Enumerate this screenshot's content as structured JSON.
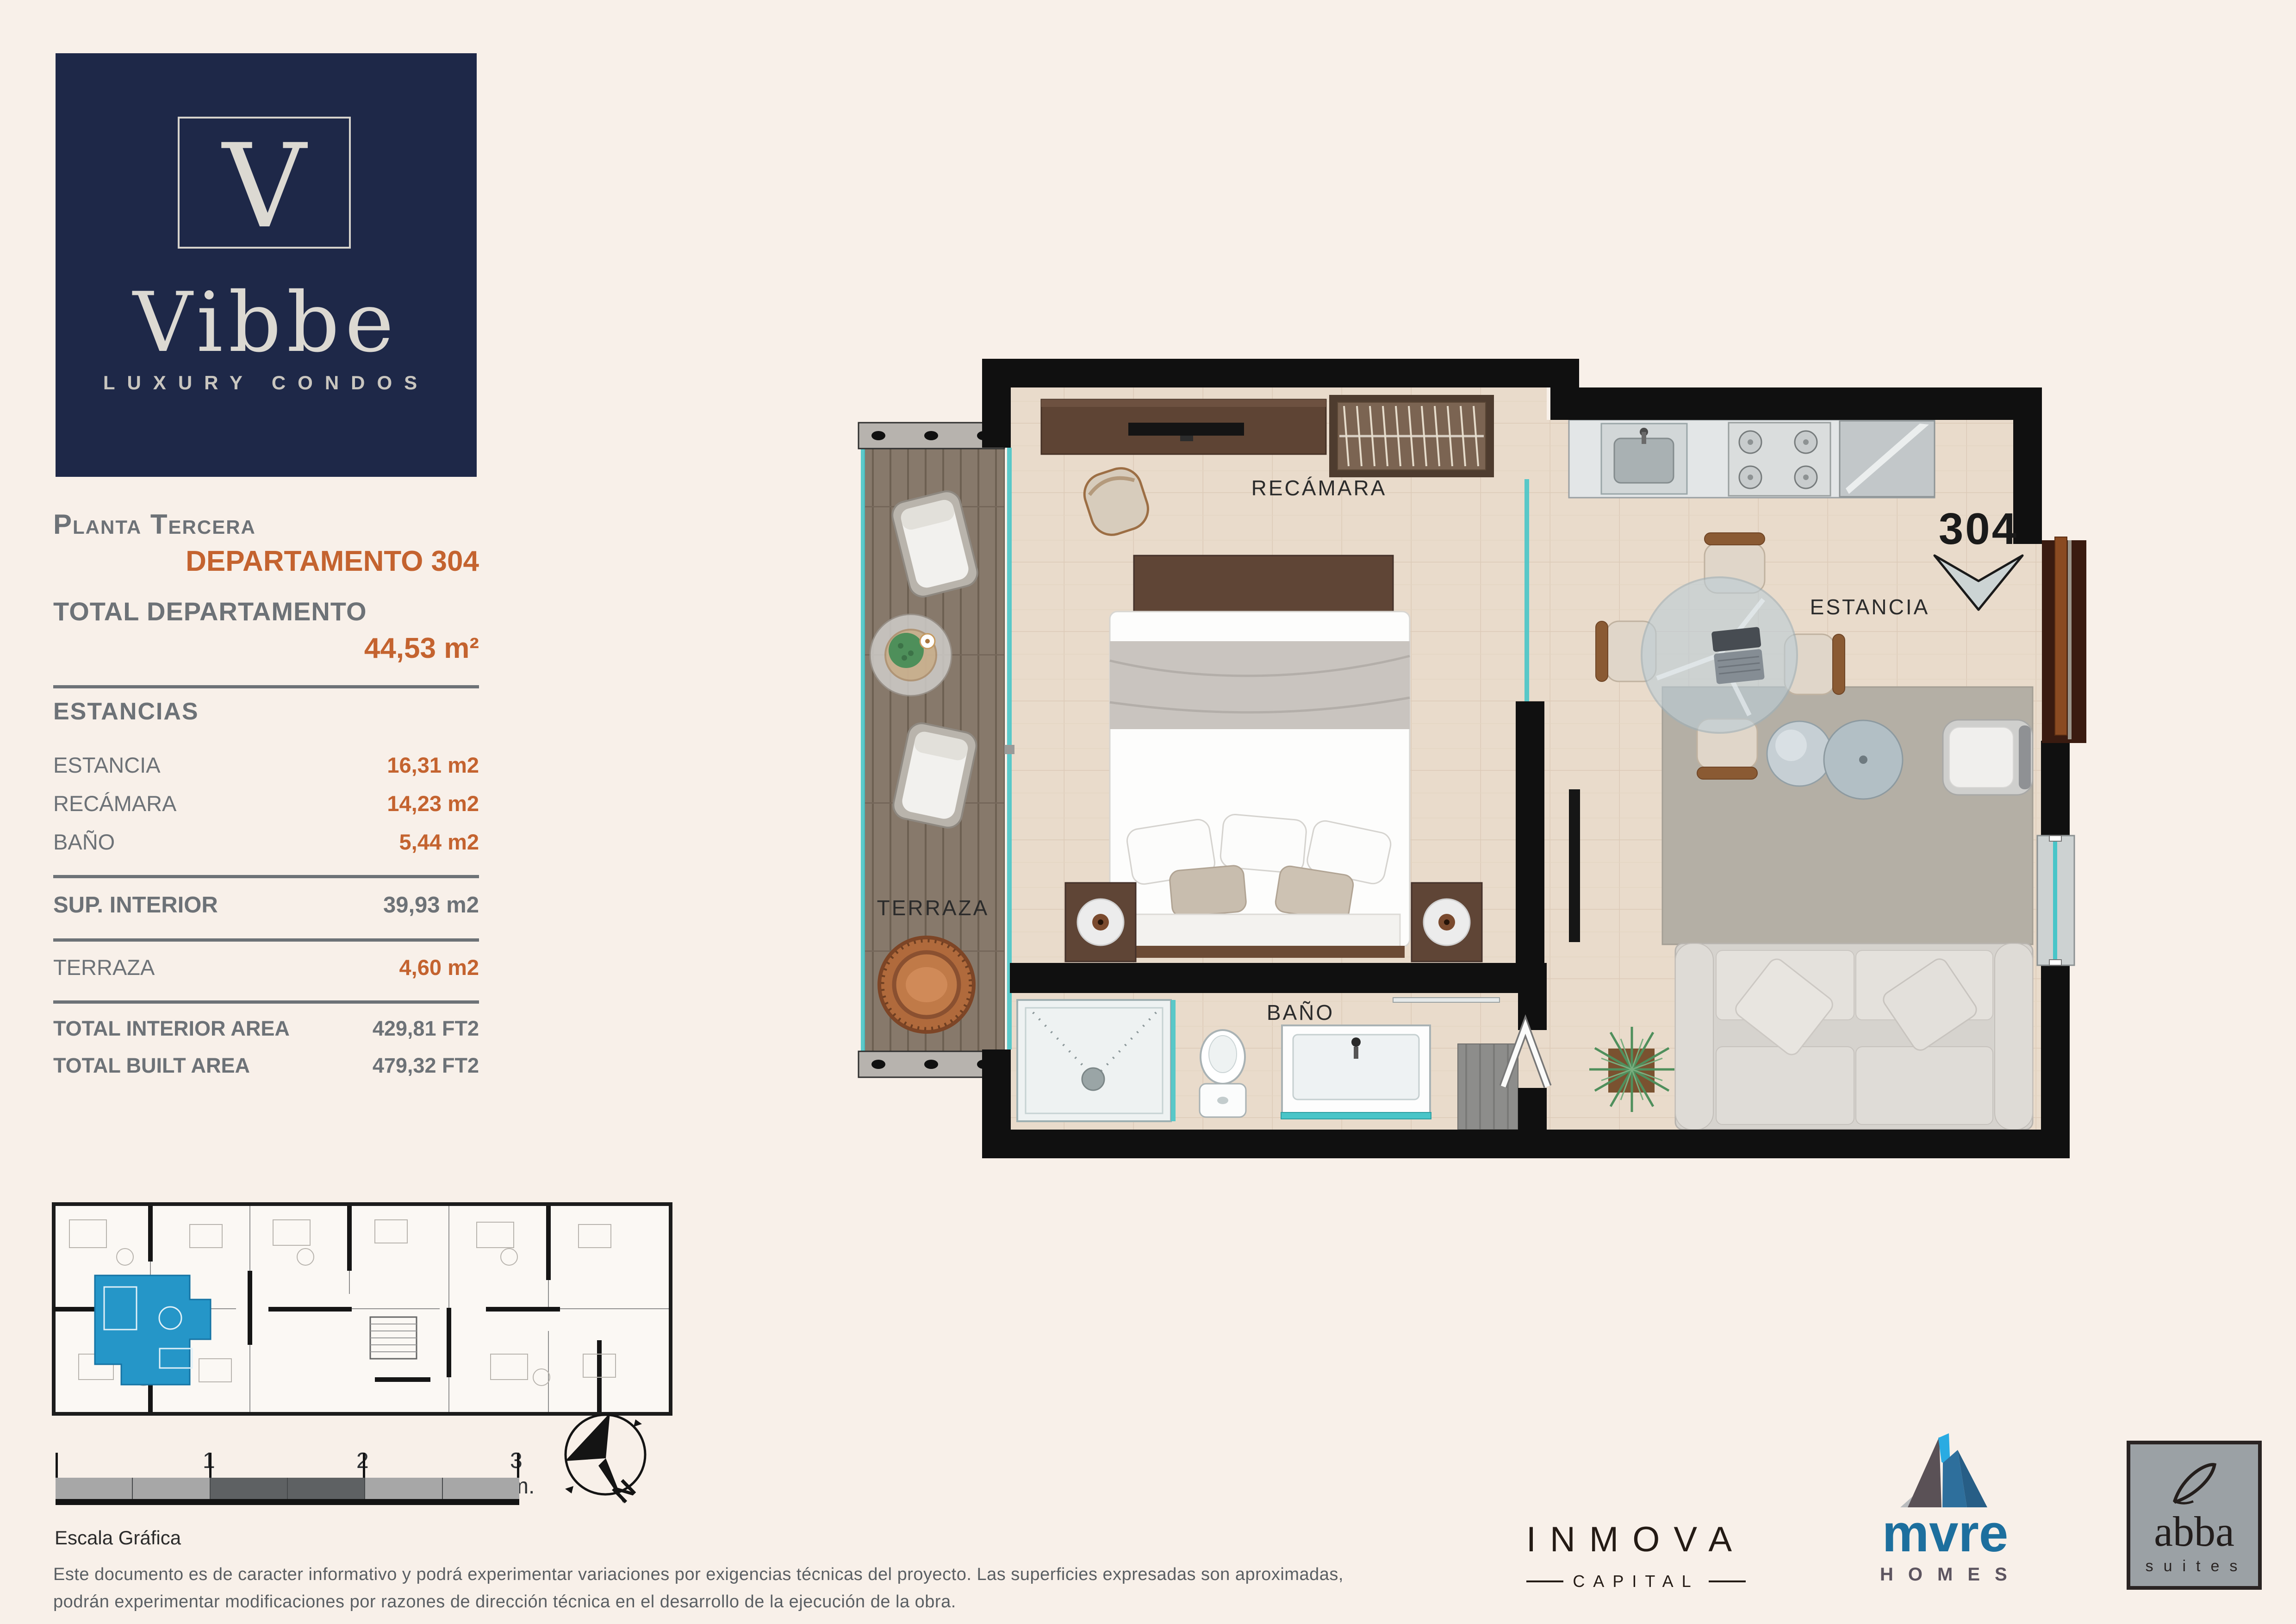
{
  "brand": {
    "monogram": "V",
    "name": "Vibbe",
    "tagline": "LUXURY CONDOS"
  },
  "sidebar": {
    "floor_label": "Planta Tercera",
    "unit_label": "DEPARTAMENTO 304",
    "total_label": "TOTAL DEPARTAMENTO",
    "total_value": "44,53 m²",
    "estancias_header": "ESTANCIAS",
    "estancias": [
      {
        "label": "ESTANCIA",
        "value": "16,31 m2"
      },
      {
        "label": "RECÁMARA",
        "value": "14,23 m2"
      },
      {
        "label": "BAÑO",
        "value": "5,44 m2"
      }
    ],
    "sup_interior_label": "SUP. INTERIOR",
    "sup_interior_value": "39,93 m2",
    "terraza_label": "TERRAZA",
    "terraza_value": "4,60 m2",
    "totals": [
      {
        "label": "TOTAL INTERIOR AREA",
        "value": "429,81 FT2"
      },
      {
        "label": "TOTAL BUILT AREA",
        "value": "479,32 FT2"
      }
    ]
  },
  "plan": {
    "labels": {
      "recamara": "RECÁMARA",
      "terraza": "TERRAZA",
      "bano": "BAÑO",
      "estancia": "ESTANCIA",
      "unit_number": "304"
    }
  },
  "scalebar": {
    "ticks": [
      "1",
      "2",
      "3 m."
    ],
    "caption": "Escala Gráfica"
  },
  "compass": {
    "north_label": "N"
  },
  "disclaimer": {
    "line1": "Este documento es de caracter informativo y podrá experimentar variaciones por exigencias técnicas del proyecto. Las superficies expresadas son aproximadas,",
    "line2": "podrán experimentar modificaciones por razones de dirección técnica en el desarrollo de la ejecución de la obra."
  },
  "partners": {
    "inmova": {
      "name": "INMOVA",
      "sub": "CAPITAL"
    },
    "mvre": {
      "name": "mvre",
      "sub": "HOMES"
    },
    "abba": {
      "name": "abba",
      "sub": "suites"
    }
  },
  "colors": {
    "background": "#f8f0e9",
    "navy": "#1e2848",
    "accent_orange": "#c4632f",
    "text_gray": "#6d7277",
    "plan_wall_black": "#101010",
    "keyplan_highlight_blue": "#2596c8",
    "glass_teal": "#49c5c8",
    "mvre_blue": "#1d6f9e",
    "mvre_cyan": "#29abe2",
    "abba_gray": "#9ba1a5"
  }
}
